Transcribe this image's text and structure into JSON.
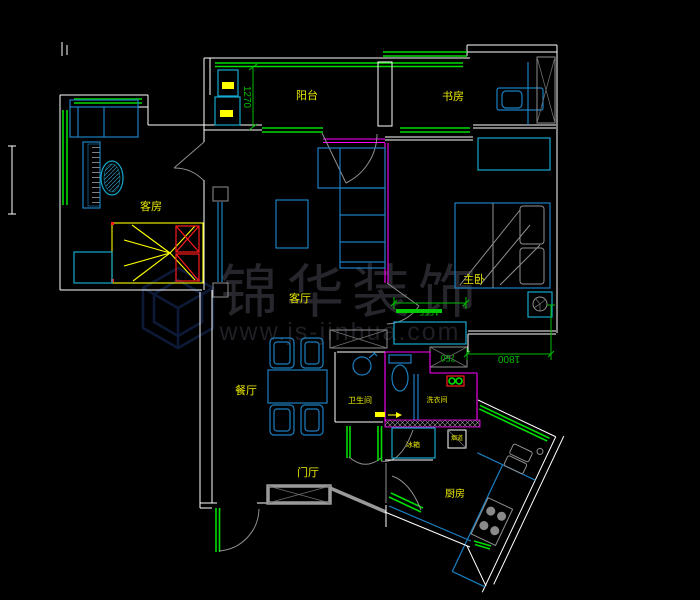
{
  "drawing": {
    "type": "cad-floor-plan",
    "background": "#000000",
    "watermark": {
      "brand": "锦华装饰",
      "url": "www.js-jinhua.com"
    },
    "rooms": [
      {
        "id": "balcony",
        "label": "阳台"
      },
      {
        "id": "study",
        "label": "书房"
      },
      {
        "id": "guest-room",
        "label": "客房"
      },
      {
        "id": "master-bedroom",
        "label": "主卧"
      },
      {
        "id": "living-room",
        "label": "客厅"
      },
      {
        "id": "dining-room",
        "label": "餐厅"
      },
      {
        "id": "entry-hall",
        "label": "门厅"
      },
      {
        "id": "bathroom",
        "label": "卫生间"
      },
      {
        "id": "laundry",
        "label": "洗衣间"
      },
      {
        "id": "kitchen",
        "label": "厨房"
      }
    ],
    "annotations": [
      {
        "id": "fridge",
        "label": "冰箱"
      },
      {
        "id": "flue",
        "label": "烟道"
      }
    ],
    "dimensions": [
      {
        "id": "balcony-depth",
        "value": "1270",
        "orientation": "vertical"
      },
      {
        "id": "wardrobe-width",
        "value": "1555",
        "orientation": "horizontal"
      },
      {
        "id": "cabinet-width",
        "value": "750",
        "orientation": "horizontal"
      },
      {
        "id": "passage-width",
        "value": "1800",
        "orientation": "horizontal"
      }
    ],
    "colors": {
      "wall": "#ffffff",
      "window": "#00dd00",
      "dimension": "#00bb00",
      "furniture_blue": "#1a7fc0",
      "furniture_cyan": "#15aacd",
      "label_yellow": "#e8e800",
      "highlight_yellow": "#ffff00",
      "accent_red": "#ff1a1a",
      "accent_magenta": "#ff00ff",
      "hatch_gray": "#8f8f8f",
      "watermark_gray": "#26262c"
    }
  }
}
